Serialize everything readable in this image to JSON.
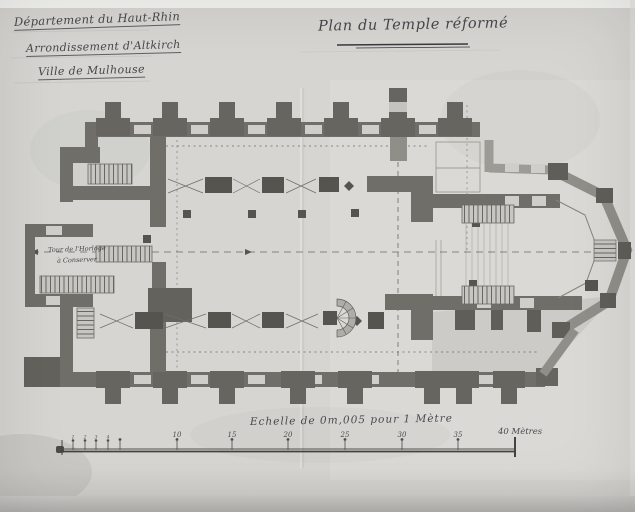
{
  "header": {
    "department": "Département du Haut-Rhin",
    "arrondissement": "Arrondissement d'Altkirch",
    "city": "Ville de Mulhouse"
  },
  "title": "Plan du Temple réformé",
  "annotations": {
    "tower_line1": "Tour de l'Horloge",
    "tower_line2": "à Conserver"
  },
  "scale": {
    "caption": "Echelle de 0m,005 pour 1 Mètre",
    "minor_labels": [
      "1",
      "2",
      "3",
      "4"
    ],
    "major_labels": [
      "10",
      "15",
      "20",
      "25",
      "30",
      "35"
    ],
    "end_label": "40 Mètres"
  },
  "colors": {
    "paper": "#d6d5d1",
    "ink": "#45444a",
    "wall_dark": "#55544f",
    "wall_mid": "#6f6e68",
    "wall_light": "#9c9b95"
  }
}
